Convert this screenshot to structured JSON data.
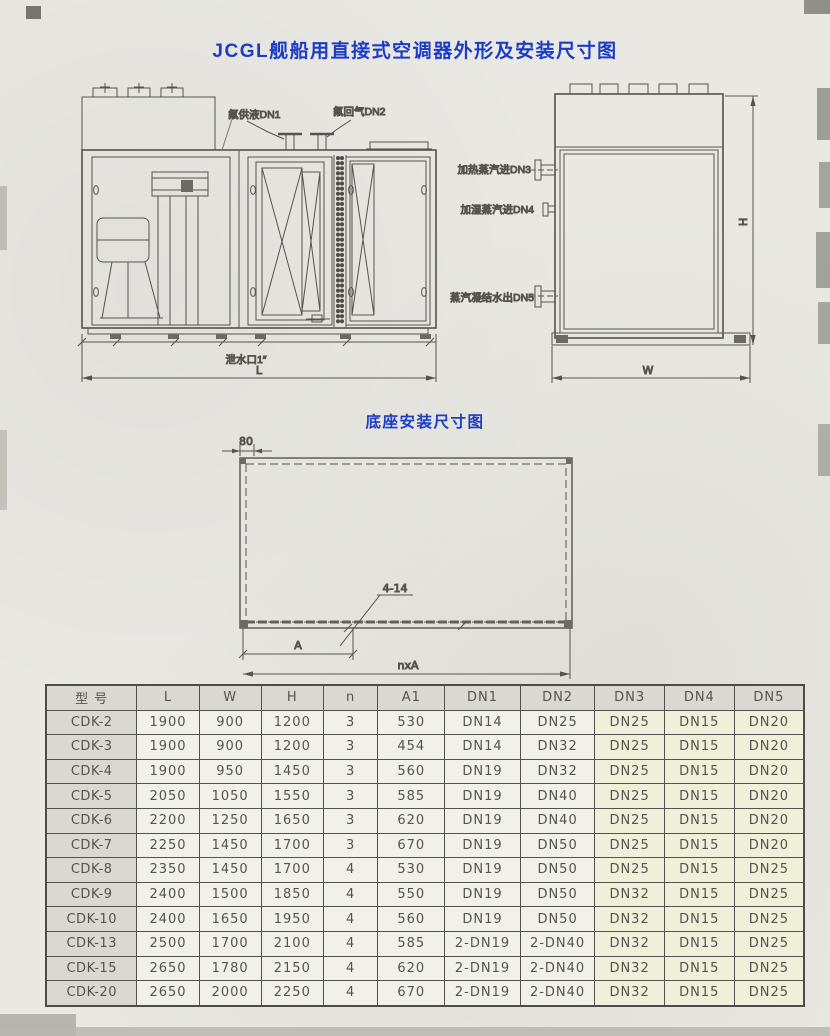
{
  "page": {
    "title": "JCGL舰船用直接式空调器外形及安装尺寸图"
  },
  "outline_drawing": {
    "front_view": {
      "pipe_label_1": "氟供液DN1",
      "pipe_label_2": "氟回气DN2",
      "drain_label": "泄水口1″",
      "length_dim": "L"
    },
    "side_view": {
      "pipe_label_3": "加热蒸汽进DN3",
      "pipe_label_4": "加湿蒸汽进DN4",
      "pipe_label_5": "蒸汽凝结水出DN5",
      "width_dim": "W",
      "height_dim": "H"
    }
  },
  "base_drawing": {
    "title": "底座安装尺寸图",
    "corner_offset_dim": "80",
    "hole_callout": "4-14",
    "pitch_dim": "A",
    "total_pitch_dim": "nxA"
  },
  "table": {
    "headers": [
      "型 号",
      "L",
      "W",
      "H",
      "n",
      "A1",
      "DN1",
      "DN2",
      "DN3",
      "DN4",
      "DN5"
    ],
    "rows": [
      [
        "CDK-2",
        "1900",
        "900",
        "1200",
        "3",
        "530",
        "DN14",
        "DN25",
        "DN25",
        "DN15",
        "DN20"
      ],
      [
        "CDK-3",
        "1900",
        "900",
        "1200",
        "3",
        "454",
        "DN14",
        "DN32",
        "DN25",
        "DN15",
        "DN20"
      ],
      [
        "CDK-4",
        "1900",
        "950",
        "1450",
        "3",
        "560",
        "DN19",
        "DN32",
        "DN25",
        "DN15",
        "DN20"
      ],
      [
        "CDK-5",
        "2050",
        "1050",
        "1550",
        "3",
        "585",
        "DN19",
        "DN40",
        "DN25",
        "DN15",
        "DN20"
      ],
      [
        "CDK-6",
        "2200",
        "1250",
        "1650",
        "3",
        "620",
        "DN19",
        "DN40",
        "DN25",
        "DN15",
        "DN20"
      ],
      [
        "CDK-7",
        "2250",
        "1450",
        "1700",
        "3",
        "670",
        "DN19",
        "DN50",
        "DN25",
        "DN15",
        "DN20"
      ],
      [
        "CDK-8",
        "2350",
        "1450",
        "1700",
        "4",
        "530",
        "DN19",
        "DN50",
        "DN25",
        "DN15",
        "DN25"
      ],
      [
        "CDK-9",
        "2400",
        "1500",
        "1850",
        "4",
        "550",
        "DN19",
        "DN50",
        "DN32",
        "DN15",
        "DN25"
      ],
      [
        "CDK-10",
        "2400",
        "1650",
        "1950",
        "4",
        "560",
        "DN19",
        "DN50",
        "DN32",
        "DN15",
        "DN25"
      ],
      [
        "CDK-13",
        "2500",
        "1700",
        "2100",
        "4",
        "585",
        "2-DN19",
        "2-DN40",
        "DN32",
        "DN15",
        "DN25"
      ],
      [
        "CDK-15",
        "2650",
        "1780",
        "2150",
        "4",
        "620",
        "2-DN19",
        "2-DN40",
        "DN32",
        "DN15",
        "DN25"
      ],
      [
        "CDK-20",
        "2650",
        "2000",
        "2250",
        "4",
        "670",
        "2-DN19",
        "2-DN40",
        "DN32",
        "DN15",
        "DN25"
      ]
    ]
  }
}
